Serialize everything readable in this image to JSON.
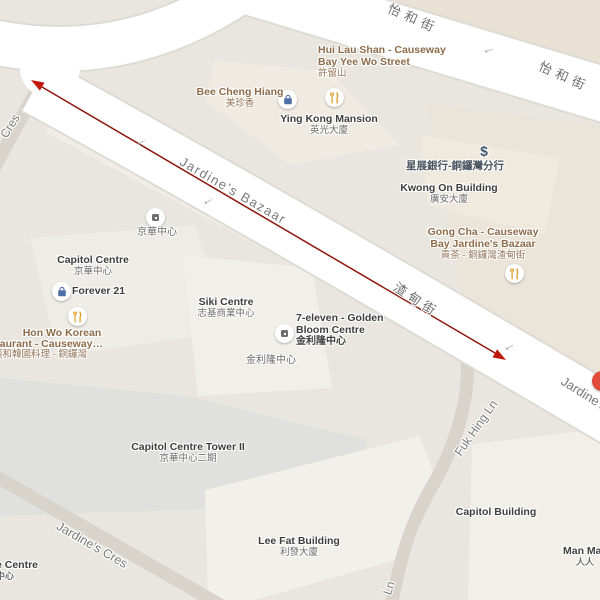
{
  "map_type": "street-map",
  "colors": {
    "background": "#e9e5df",
    "road_white": "#ffffff",
    "lane_gray": "#d8d4cc",
    "block_tan": "#e8e1d4",
    "building_light": "#f1efe9",
    "building_blue_gray": "#e0e1de",
    "street_label_gray": "#7a7a7a",
    "building_label_dark": "#3e3e3e",
    "poi_label_brown": "#8e6c49",
    "bank_label": "#4a545f",
    "measure_line_red": "#8c150b",
    "arrowhead_red": "#c0190b",
    "bag_icon_blue": "#4e6fa8",
    "utensils_icon_amber": "#de9a20",
    "red_poi_marker": "#e14b3c"
  },
  "streets": {
    "yee_wo_1": "怡和街",
    "yee_wo_2": "怡和街",
    "jardines_bazaar_en": "Jardine's Bazaar",
    "jardines_bazaar_zh": "渣甸街",
    "jardines_right_fragment": "Jardine's",
    "cres_fragment": "Cres",
    "jardines_cres": "Jardine's Cres",
    "fuk_hing_ln": "Fuk Hing Ln",
    "fuk_hing_ln_fragment": "Ln",
    "one_way_arrow": "←"
  },
  "pois": {
    "hui_lau_shan": {
      "line1": "Hui Lau Shan - Causeway",
      "line2": "Bay Yee Wo Street",
      "line3": "許留山",
      "icon": "restaurant-utensils"
    },
    "bee_cheng_hiang": {
      "line1": "Bee Cheng Hiang",
      "line2": "美珍香",
      "icon": "shopping-bag"
    },
    "ying_kong_mansion": {
      "line1": "Ying Kong Mansion",
      "line2": "英光大廈"
    },
    "dbs_bank": {
      "line1": "星展銀行-銅鑼灣分行",
      "icon": "dollar-sign"
    },
    "kwong_on_building": {
      "line1": "Kwong On Building",
      "line2": "廣安大廈"
    },
    "gong_cha": {
      "line1": "Gong Cha - Causeway",
      "line2": "Bay Jardine's Bazaar",
      "line3": "貢茶 - 銅鑼灣渣甸街",
      "icon": "restaurant-utensils"
    },
    "king_wah_small": {
      "line1": "京華中心",
      "icon": "building-square"
    },
    "capitol_centre": {
      "line1": "Capitol Centre",
      "line2": "京華中心"
    },
    "forever21": {
      "line1": "Forever 21",
      "icon": "shopping-bag"
    },
    "hon_wo": {
      "line1": "Hon Wo Korean",
      "line2": "Restaurant -  Causeway…",
      "line3": "漢和韓國料理 - 銅鑼灣",
      "icon": "restaurant-utensils"
    },
    "siki_centre": {
      "line1": "Siki Centre",
      "line2": "志基商業中心"
    },
    "seven_eleven": {
      "line1": "7-eleven - Golden",
      "line2": "Bloom Centre",
      "line3": "金利隆中心",
      "icon": "building-square"
    },
    "golden_bloom_small": {
      "line1": "金利隆中心"
    },
    "capitol_tower2": {
      "line1": "Capitol Centre Tower II",
      "line2": "京華中心二期"
    },
    "lee_fat": {
      "line1": "Lee Fat Building",
      "line2": "利發大廈"
    },
    "capitol_building": {
      "line1": "Capitol Building"
    },
    "man_man": {
      "line1": "Man Man",
      "line2": "人人"
    },
    "edge_centre": {
      "line1": "e Centre",
      "line2": "中心"
    },
    "red_marker": {
      "icon": "red-circle-marker"
    }
  },
  "annotation": {
    "type": "measurement-arrow",
    "description": "double-headed red arrow along Jardine's Bazaar"
  }
}
